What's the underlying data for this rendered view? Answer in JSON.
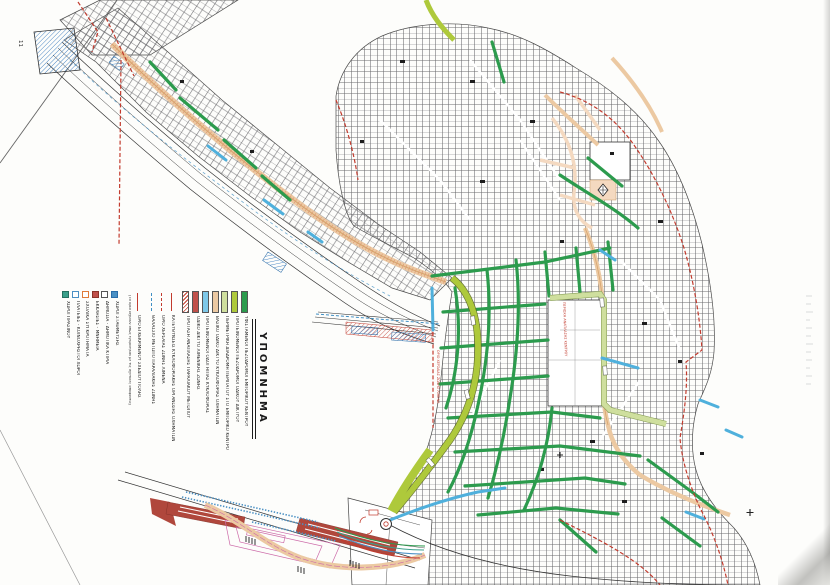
{
  "legend": {
    "title": "ΥΠΟΜΝΗΜΑ",
    "street_types": [
      {
        "color": "#2c9b4d",
        "hatch": false,
        "label": "ΥΦΙΣΤΑΜΕΝΟΙ ΠΕΖΟΔΡΟΜΟΙ ΕΜΠΟΡΙΚΟΥ ΚΕΝΤΡΟΥ"
      },
      {
        "color": "#aec93b",
        "hatch": false,
        "label": "ΠΡΟΤΕΙΝΟΜΕΝΟΙ ΠΕΖΟΔΡΟΜΟΙ ΟΔΙΚΟΥ ΔΙΚΤΥΟΥ"
      },
      {
        "color": "#cfdf9e",
        "hatch": false,
        "label": "ΠΕΡΙΜΕΤΡΙΚΗ ΔΙΑΔΡΟΜΗ ΠΕΡΙΠΑΤΟΥ ΣΤΟ ΕΜΠΟΡΙΚΟ ΚΕΝΤΡΟ"
      },
      {
        "color": "#ecc9a2",
        "hatch": false,
        "label": "ΒΑΣΙΚΟ ΟΔΙΚΟ ΔΙΚΤΥΟ ΚΥΚΛΟΦΟΡΙΑΣ ΟΧΗΜΑΤΩΝ"
      },
      {
        "color": "#7ec8e8",
        "hatch": false,
        "label": "ΠΡΟΤΕΙΝΟΜΕΝΟΙ ΟΔΟΙ ΗΠΙΑΣ ΚΥΚΛΟΦΟΡΙΑΣ"
      },
      {
        "color": "#c0504a",
        "hatch": false,
        "label": "ΟΔΙΚΟ ΔΙΚΤΥΟ ΛΙΜΕΝΙΚΗΣ ΖΩΝΗΣ"
      },
      {
        "color": "#c23b2e",
        "hatch": true,
        "label": "ΠΡΟΤΑΣΗ ΑΝΑΠΛΑΣΗΣ ΠΑΡΑΛΙΑΚΟΥ ΜΕΤΩΠΟΥ"
      }
    ],
    "line_symbols": [
      {
        "style": "solid",
        "color": "#c23b2e",
        "label": "ΚΑΤΕΥΘΥΝΣΕΙΣ ΚΥΚΛΟΦΟΡΙΑΚΗΣ ΟΡΓΑΝΩΣΗΣ ΟΧΗΜΑΤΩΝ"
      },
      {
        "style": "dashed",
        "color": "#c23b2e",
        "label": "ΟΡΙΟ ΧΕΡΣΑΙΑΣ ΖΩΝΗΣ ΛΙΜΕΝΑ"
      },
      {
        "style": "dashed",
        "color": "#3f8fc4",
        "label": "ΘΑΛΑΣΣΙΟ ΜΕΤΩΠΟ ΠΑΡΑΛΙΑΚΗΣ ΖΩΝΗΣ"
      }
    ],
    "boundary": {
      "color": "#c23b2e",
      "label": "ΟΡΙΟ ΕΓΚΕΚΡΙΜΕΝΟΥ ΣΧΕΔΙΟΥ ΠΟΛΗΣ",
      "note": "(Τα όρια ισχύουν όπως εγκρίθηκαν με τις σχετικές αποφάσεις)"
    },
    "area_symbols": [
      {
        "fill": "#4a90c4",
        "outline": "#2a6ca8",
        "label": "ΧΩΡΟΙ ΣΤΑΘΜΕΥΣΗΣ"
      },
      {
        "fill": "#ffffff",
        "outline": "#555555",
        "label": "ΔΗΜΟΣΙΑ - ΔΗΜΟΤΙΚΑ ΚΤΙΡΙΑ"
      },
      {
        "fill": "#c0504a",
        "outline": "#8a3328",
        "label": "ΕΚΚΛΗΣΙΕΣ - ΜΝΗΜΕΙΑ"
      },
      {
        "fill": "#ffffff",
        "outline": "#e07b39",
        "label": "ΣΧΟΛΙΚΑ ΣΥΓΚΡΟΤΗΜΑΤΑ"
      },
      {
        "fill": "#ffffff",
        "outline": "#4a90c4",
        "label": "ΠΛΑΤΕΙΕΣ - ΚΟΙΝΟΧΡΗΣΤΟΙ ΧΩΡΟΙ"
      },
      {
        "fill": "#3aa08a",
        "outline": "#25705f",
        "label": "ΧΩΡΟΙ ΠΡΑΣΙΝΟΥ"
      }
    ]
  },
  "map": {
    "labels": {
      "port_zone_boundary": "ΟΡΙΟ ΧΕΡΣΑΙΑΣ ΖΩΝΗΣ ΛΙΜΕΝΑ",
      "renewal_area": "ΠΕΡΙΟΧΗ ΑΝΑΠΛΑΣΗΣ ΚΕΝΤΡΟΥ",
      "sheet_mark": "11"
    },
    "colors": {
      "pedestrian_green": "#2c9b4d",
      "proposed_chartreuse": "#aec93b",
      "walk_ring_pale": "#cfdf9e",
      "vehicle_tan": "#ecc9a2",
      "calm_blue": "#4fb0dc",
      "boundary_red": "#c23b2e",
      "harbor_darkred": "#b0473c"
    }
  }
}
